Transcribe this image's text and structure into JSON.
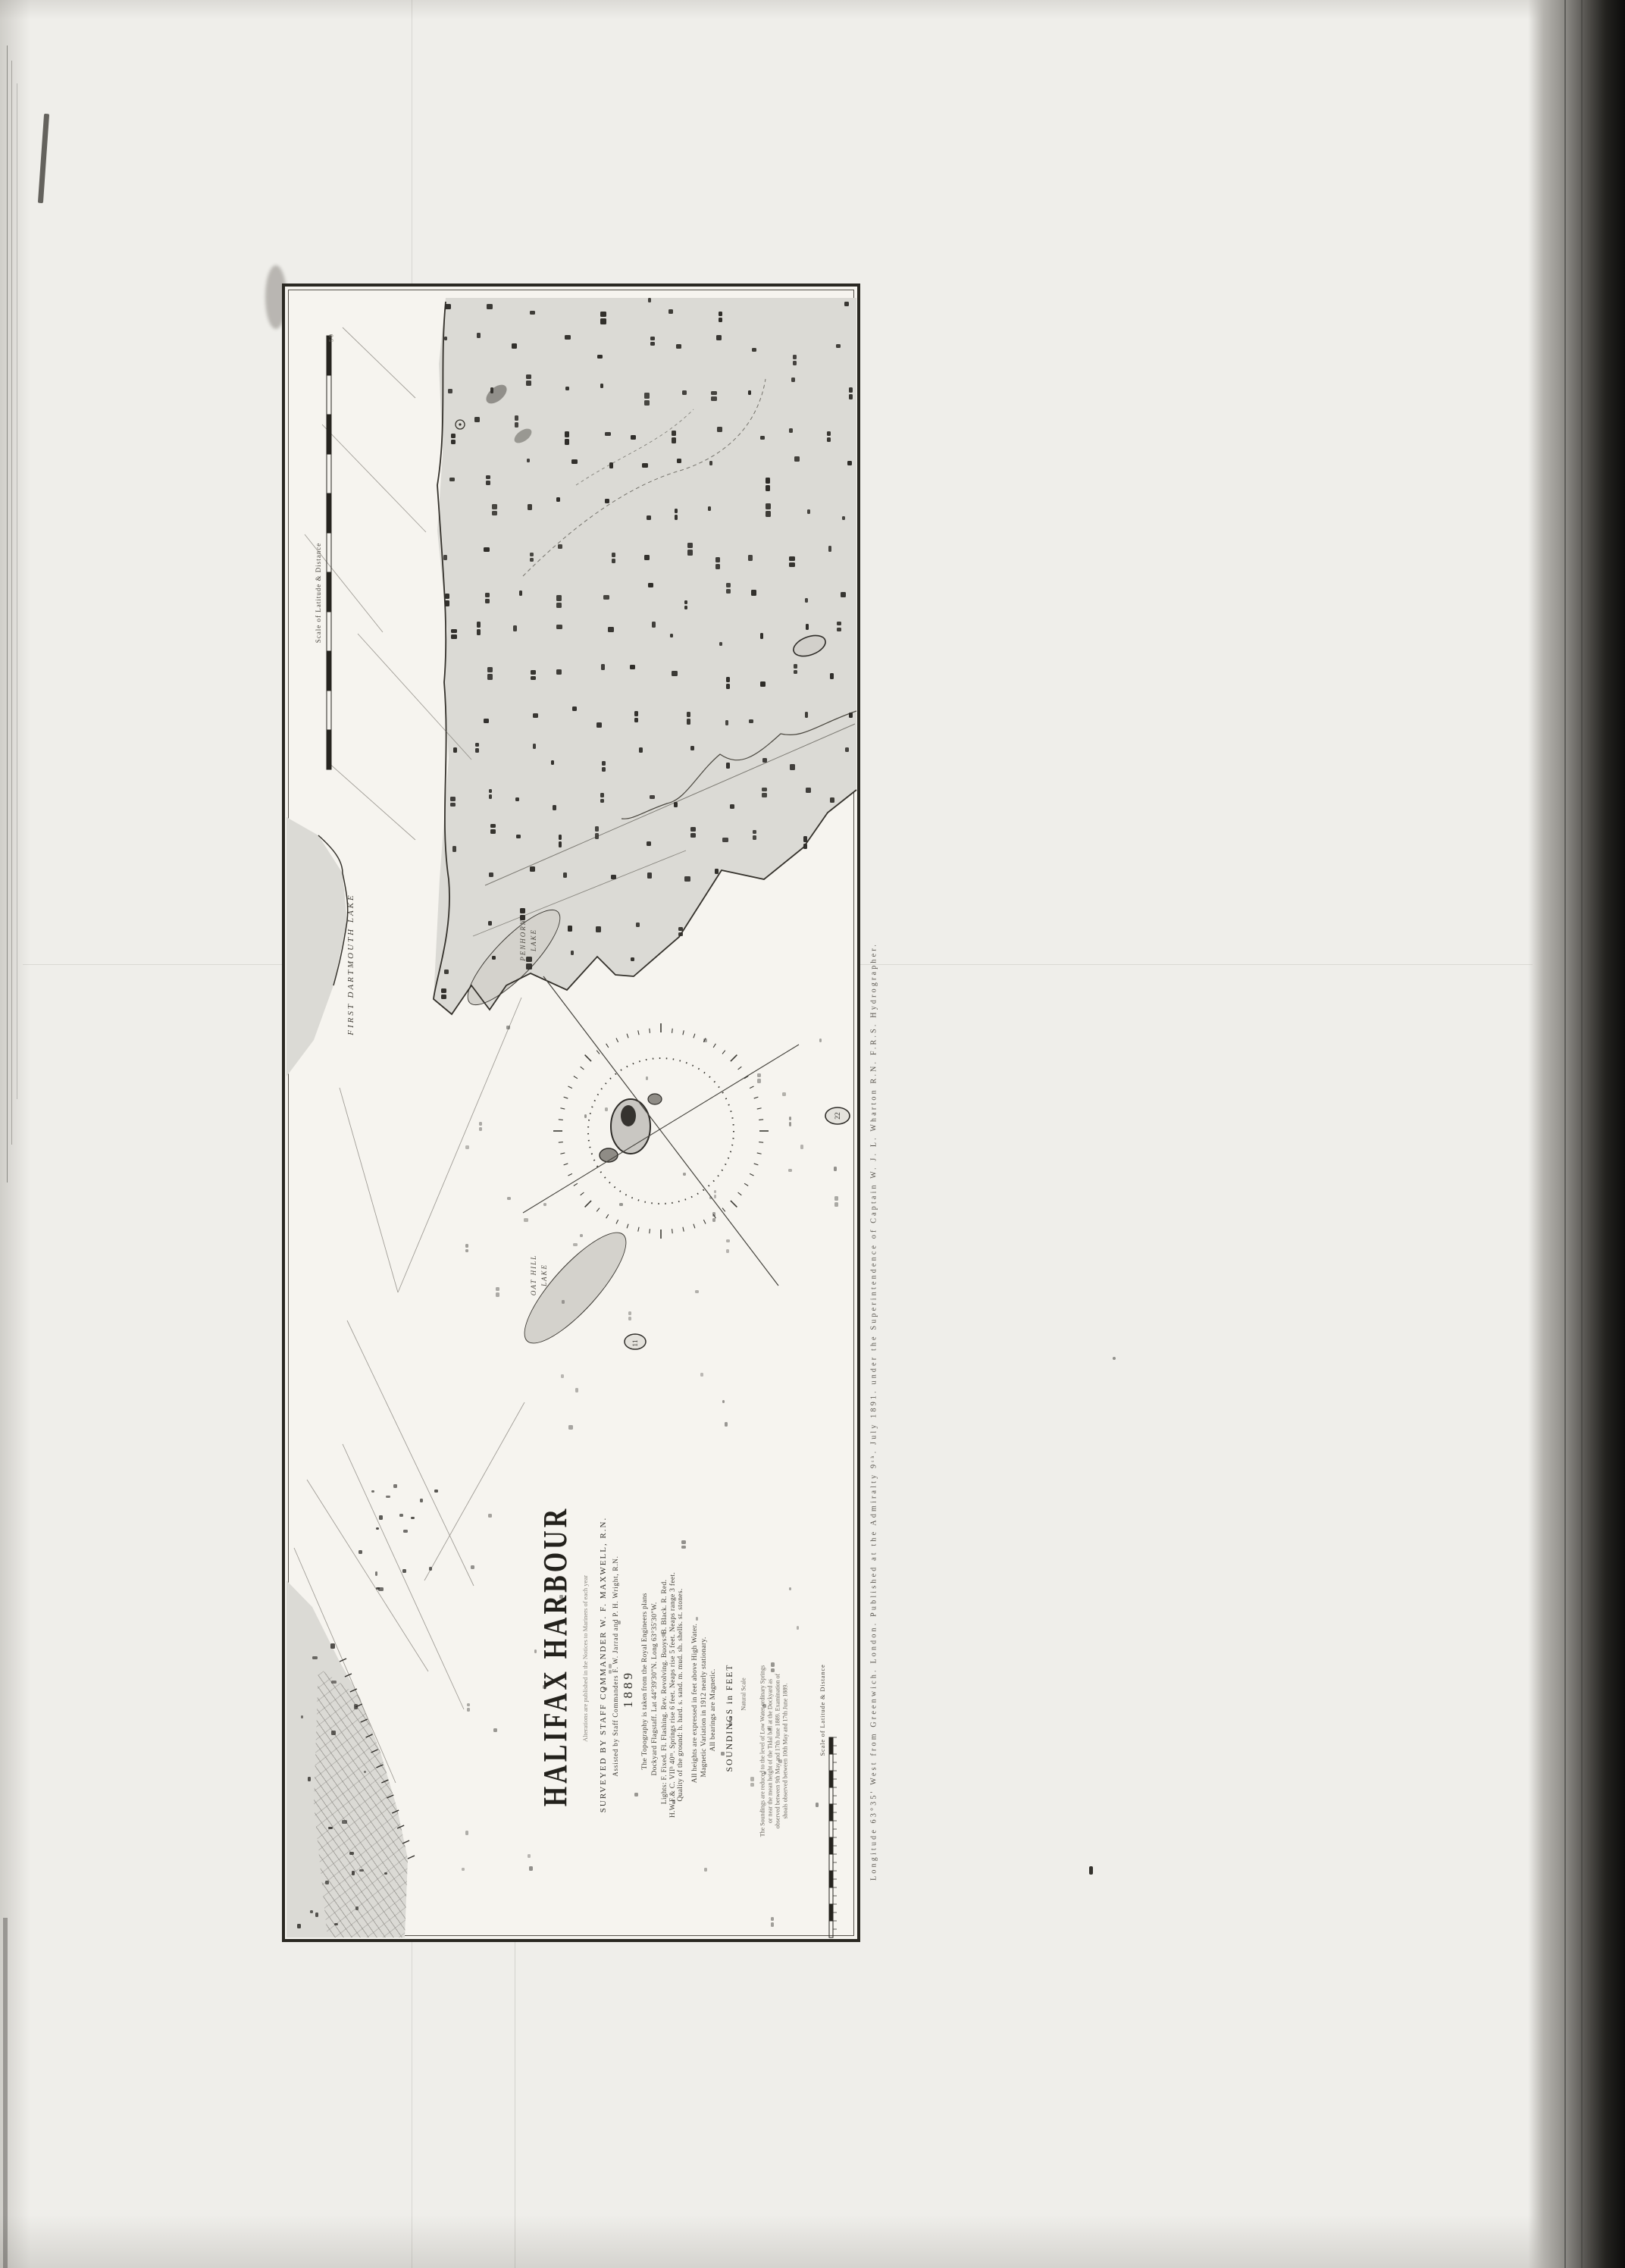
{
  "page": {
    "description": "Scanned book page with fold-out Admiralty nautical chart",
    "paper_color": "#efeeea",
    "chart_paper_color": "#f6f4ef",
    "stipple_color": "#dbdad5",
    "ink_color": "#2b2923",
    "book_edge_color": "#0c0c0b"
  },
  "chart": {
    "title": "HALIFAX HARBOUR",
    "alterations_note": "Alterations are published in the Notices to Mariners of each year",
    "surveyed_by": "SURVEYED BY STAFF COMMANDER W. F. MAXWELL, R.N.",
    "assisted_by": "Assisted by Staff Commanders F. W. Jarrad and P. H. Wright, R.N.",
    "year": "1889",
    "notes": [
      "The Topography is taken from the Royal Engineers plans",
      "Dockyard Flagstaff. Lat 44°39'30\"N. Long 63°35'30\"W.",
      "Lights: F. Fixed. Fl. Flashing. Rev. Revolving. Buoys: B. Black. R. Red.",
      "H.W.F.& C. VIIʰ 40ᵐ. Springs rise 6 feet. Neaps rise 5 feet. Neaps range 3 feet.",
      "Quality of the ground: h. hard. s. sand. m. mud. sh. shells. st. stones.",
      "All heights are expressed in feet above High Water.",
      "Magnetic Variation in 1912 nearly stationary.",
      "All bearings are Magnetic."
    ],
    "soundings_unit": "SOUNDINGS in FEET",
    "natural_scale": "Natural Scale",
    "tide_note": [
      "The Soundings are reduced to the level of Low Water ordinary Springs",
      "or near the mean height of the Tidal ball at the Dockyard as",
      "observed between 9th May and 17th June 1889. Examination of",
      "shoals observed between 10th May and 17th June 1889."
    ],
    "scale_label_upper": "Scale of Latitude & Distance",
    "scale_label_lower": "Scale of Latitude & Distance",
    "scale_end_labels": "5   0",
    "imprint": "Longitude 63°35' West from Greenwich.        London. Published at the Admiralty 9ᵗʰ. July 1891. under the Superintendence of Captain W. J. L. Wharton R.N. F.R.S. Hydrographer.",
    "place_labels": {
      "first_dartmouth_lake": "FIRST DARTMOUTH LAKE",
      "penhorn_lake_line1": "PENHORN",
      "penhorn_lake_line2": "LAKE",
      "oat_hill_lake_line1": "OAT HILL",
      "oat_hill_lake_line2": "LAKE"
    },
    "islet_depths": {
      "east": "22",
      "south": "11"
    }
  }
}
